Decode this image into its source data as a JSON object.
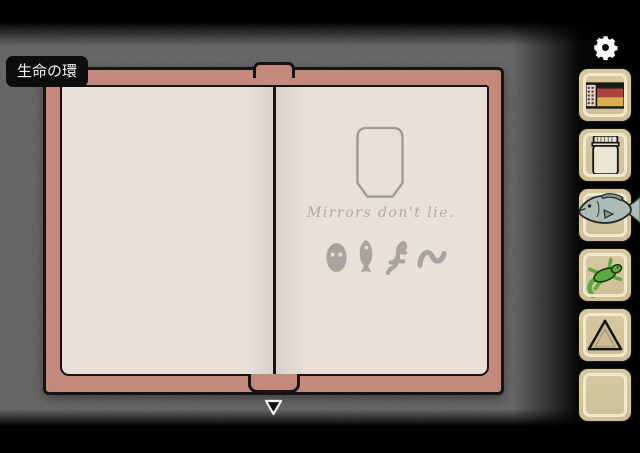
{
  "hud": {
    "location_label": "生命の環",
    "settings_icon": "gear-icon",
    "advance_icon": "down-arrow-icon"
  },
  "book": {
    "left_page": {
      "content": ""
    },
    "right_page": {
      "mirror_shape": "octagon-mirror-outline",
      "quote": "Mirrors don't lie.",
      "symbols": [
        {
          "name": "alien-head-symbol"
        },
        {
          "name": "fish-symbol"
        },
        {
          "name": "lizard-symbol"
        },
        {
          "name": "worm-symbol"
        }
      ]
    }
  },
  "inventory": {
    "slots": [
      {
        "index": 1,
        "item": "matchbox",
        "icon": "matchbox-icon"
      },
      {
        "index": 2,
        "item": "jar",
        "icon": "jar-icon"
      },
      {
        "index": 3,
        "item": "fish",
        "icon": "fish-icon"
      },
      {
        "index": 4,
        "item": "lizard",
        "icon": "lizard-icon"
      },
      {
        "index": 5,
        "item": "triangle-device",
        "icon": "triangle-icon"
      },
      {
        "index": 6,
        "item": "empty",
        "icon": ""
      }
    ]
  },
  "colors": {
    "cover_pink": "#c5897c",
    "page_cream": "#e9e0da",
    "background_gray": "#5a5a5a",
    "slot_tan": "#d2c39a",
    "slot_inner_stroke": "#f1e8cf",
    "symbol_gray": "#a7a49f",
    "quote_gray": "#b2a8a2",
    "outline_black": "#141414",
    "lizard_green": "#5aa93e",
    "fish_gray_blue": "#aebcb8",
    "match_red": "#b0403a",
    "match_gold": "#d9ae4e"
  }
}
